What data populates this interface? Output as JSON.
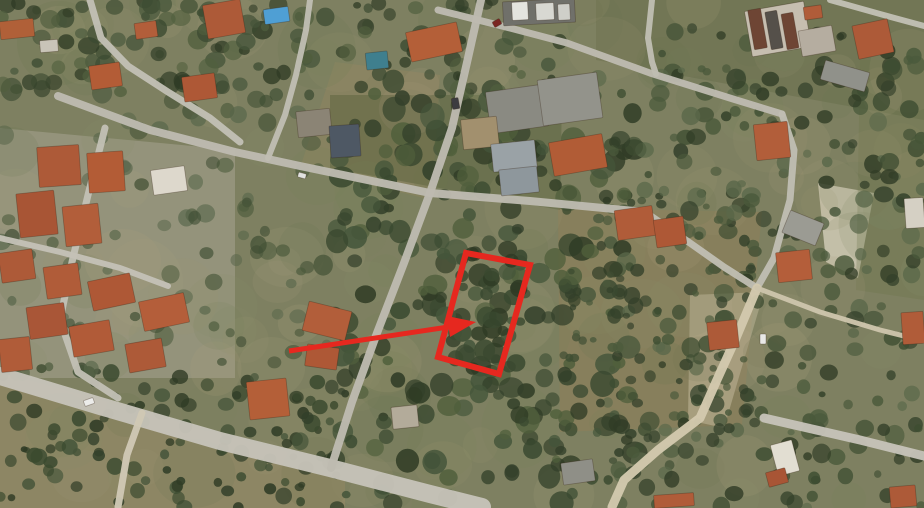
{
  "meta": {
    "description": "Aerial satellite photograph of a residential olive-grove neighbourhood; a red rectangle outlines a tree-covered land parcel and a red arrow points to it from a house to the south-west."
  },
  "scene": {
    "width": 924,
    "height": 508,
    "base_color": "#7e8061",
    "patches": [
      {
        "points": [
          [
            0,
            128
          ],
          [
            235,
            150
          ],
          [
            235,
            378
          ],
          [
            0,
            378
          ]
        ],
        "color": "#b3ae9f",
        "opacity": 0.42
      },
      {
        "points": [
          [
            558,
            208
          ],
          [
            762,
            212
          ],
          [
            742,
            425
          ],
          [
            560,
            432
          ]
        ],
        "color": "#8f7d57",
        "opacity": 0.5
      },
      {
        "points": [
          [
            0,
            372
          ],
          [
            345,
            468
          ],
          [
            345,
            508
          ],
          [
            0,
            508
          ]
        ],
        "color": "#9c8c68",
        "opacity": 0.5
      },
      {
        "points": [
          [
            335,
            62
          ],
          [
            440,
            75
          ],
          [
            432,
            200
          ],
          [
            300,
            168
          ]
        ],
        "color": "#97855f",
        "opacity": 0.4
      },
      {
        "points": [
          [
            818,
            183
          ],
          [
            874,
            193
          ],
          [
            858,
            278
          ],
          [
            826,
            262
          ]
        ],
        "color": "#d9d2bf",
        "opacity": 0.9
      },
      {
        "points": [
          [
            690,
            295
          ],
          [
            764,
            292
          ],
          [
            724,
            428
          ],
          [
            688,
            420
          ]
        ],
        "color": "#cfc5a8",
        "opacity": 0.45
      },
      {
        "points": [
          [
            330,
            95
          ],
          [
            562,
            95
          ],
          [
            560,
            210
          ],
          [
            330,
            168
          ]
        ],
        "color": "#49552f",
        "opacity": 0.35
      },
      {
        "points": [
          [
            596,
            0
          ],
          [
            924,
            0
          ],
          [
            924,
            120
          ],
          [
            596,
            60
          ]
        ],
        "color": "#55603c",
        "opacity": 0.3
      },
      {
        "points": [
          [
            860,
            60
          ],
          [
            924,
            60
          ],
          [
            924,
            300
          ],
          [
            856,
            290
          ]
        ],
        "color": "#6b7448",
        "opacity": 0.3
      }
    ],
    "tree_regions": [
      {
        "seed": 11,
        "x": 0,
        "y": 0,
        "w": 924,
        "h": 508,
        "count": 160,
        "rmin": 16,
        "rmax": 42,
        "opacity": 0.18,
        "palette": [
          "#75805a",
          "#8a8f68",
          "#9c9372",
          "#68744e",
          "#aa9f7d"
        ]
      },
      {
        "seed": 21,
        "x": 330,
        "y": 88,
        "w": 305,
        "h": 420,
        "count": 260,
        "rmin": 4,
        "rmax": 13,
        "opacity": 0.88,
        "palette": [
          "#2f3b25",
          "#3a4930",
          "#44553a",
          "#505f3c",
          "#33402a"
        ]
      },
      {
        "seed": 31,
        "x": 598,
        "y": 28,
        "w": 326,
        "h": 480,
        "count": 300,
        "rmin": 3.5,
        "rmax": 10,
        "opacity": 0.85,
        "palette": [
          "#33402a",
          "#3e4d32",
          "#4a593b",
          "#5a684a",
          "#2f3b25"
        ]
      },
      {
        "seed": 41,
        "x": 0,
        "y": 368,
        "w": 348,
        "h": 140,
        "count": 120,
        "rmin": 3.5,
        "rmax": 8.5,
        "opacity": 0.9,
        "palette": [
          "#33402a",
          "#3b4a2f",
          "#2f3b25",
          "#46553a"
        ]
      },
      {
        "seed": 51,
        "x": 0,
        "y": 0,
        "w": 560,
        "h": 95,
        "count": 140,
        "rmin": 4,
        "rmax": 11,
        "opacity": 0.8,
        "palette": [
          "#3a4930",
          "#46553a",
          "#515f3e",
          "#2f3b25"
        ]
      },
      {
        "seed": 61,
        "x": 0,
        "y": 95,
        "w": 335,
        "h": 285,
        "count": 90,
        "rmin": 4,
        "rmax": 10,
        "opacity": 0.7,
        "palette": [
          "#3e4d32",
          "#4a593b",
          "#57654a"
        ]
      },
      {
        "seed": 71,
        "x": 437,
        "y": 253,
        "w": 92,
        "h": 118,
        "count": 34,
        "rmin": 5,
        "rmax": 11,
        "opacity": 0.9,
        "palette": [
          "#2f3b25",
          "#3a4930",
          "#44553a"
        ]
      },
      {
        "seed": 81,
        "x": 560,
        "y": 200,
        "w": 200,
        "h": 230,
        "count": 70,
        "rmin": 3,
        "rmax": 7,
        "opacity": 0.85,
        "palette": [
          "#3e4d32",
          "#4a593b",
          "#33402a"
        ]
      }
    ],
    "roads": [
      {
        "points": [
          [
            0,
            376
          ],
          [
            100,
            406
          ],
          [
            220,
            441
          ],
          [
            330,
            468
          ],
          [
            430,
            494
          ],
          [
            482,
            507
          ]
        ],
        "width": 18,
        "color": "#c6c3b8"
      },
      {
        "points": [
          [
            142,
            413
          ],
          [
            127,
            455
          ],
          [
            118,
            507
          ]
        ],
        "width": 7,
        "color": "#cfc8b4"
      },
      {
        "points": [
          [
            481,
            0
          ],
          [
            468,
            58
          ],
          [
            452,
            128
          ],
          [
            430,
            193
          ],
          [
            404,
            263
          ],
          [
            377,
            333
          ],
          [
            352,
            402
          ],
          [
            331,
            468
          ]
        ],
        "width": 8,
        "color": "#bdbab0"
      },
      {
        "points": [
          [
            58,
            96
          ],
          [
            150,
            130
          ],
          [
            235,
            152
          ],
          [
            300,
            166
          ],
          [
            430,
            193
          ],
          [
            530,
            201
          ],
          [
            645,
            212
          ]
        ],
        "width": 8,
        "color": "#bdbab0"
      },
      {
        "points": [
          [
            645,
            212
          ],
          [
            690,
            243
          ],
          [
            724,
            267
          ],
          [
            757,
            288
          ]
        ],
        "width": 7,
        "color": "#c0bdb2"
      },
      {
        "points": [
          [
            438,
            10
          ],
          [
            510,
            28
          ],
          [
            567,
            43
          ],
          [
            650,
            73
          ],
          [
            733,
            99
          ],
          [
            782,
            114
          ]
        ],
        "width": 7,
        "color": "#bdbab0"
      },
      {
        "points": [
          [
            782,
            114
          ],
          [
            794,
            150
          ],
          [
            790,
            200
          ],
          [
            774,
            258
          ],
          [
            757,
            288
          ]
        ],
        "width": 7,
        "color": "#c0bdb2"
      },
      {
        "points": [
          [
            757,
            288
          ],
          [
            736,
            338
          ],
          [
            716,
            382
          ],
          [
            700,
            418
          ],
          [
            658,
            450
          ],
          [
            624,
            480
          ],
          [
            612,
            507
          ]
        ],
        "width": 9,
        "color": "#d2c9ae"
      },
      {
        "points": [
          [
            90,
            0
          ],
          [
            101,
            38
          ],
          [
            128,
            66
          ],
          [
            168,
            92
          ],
          [
            210,
            118
          ],
          [
            240,
            142
          ]
        ],
        "width": 7,
        "color": "#c2bfb4"
      },
      {
        "points": [
          [
            105,
            128
          ],
          [
            88,
            195
          ],
          [
            72,
            262
          ],
          [
            60,
            320
          ],
          [
            78,
            372
          ],
          [
            118,
            398
          ]
        ],
        "width": 7,
        "color": "#c2bfb4"
      },
      {
        "points": [
          [
            0,
            238
          ],
          [
            60,
            252
          ],
          [
            120,
            268
          ],
          [
            168,
            286
          ]
        ],
        "width": 6,
        "color": "#c4c1b6"
      },
      {
        "points": [
          [
            652,
            0
          ],
          [
            648,
            38
          ],
          [
            652,
            62
          ],
          [
            656,
            74
          ]
        ],
        "width": 6,
        "color": "#c0bdb2"
      },
      {
        "points": [
          [
            757,
            288
          ],
          [
            820,
            312
          ],
          [
            880,
            330
          ],
          [
            924,
            341
          ]
        ],
        "width": 5,
        "color": "#cdc5ac"
      },
      {
        "points": [
          [
            830,
            0
          ],
          [
            880,
            14
          ],
          [
            924,
            26
          ]
        ],
        "width": 6,
        "color": "#c2bfb4"
      },
      {
        "points": [
          [
            764,
            418
          ],
          [
            860,
            440
          ],
          [
            924,
            456
          ]
        ],
        "width": 9,
        "color": "#c6c3b8"
      },
      {
        "points": [
          [
            268,
            158
          ],
          [
            285,
            115
          ],
          [
            296,
            75
          ],
          [
            306,
            30
          ],
          [
            310,
            0
          ]
        ],
        "width": 6,
        "color": "#c0bdb2"
      }
    ],
    "buildings": [
      [
        38,
        146,
        42,
        40,
        -4,
        "#ad5a38"
      ],
      [
        88,
        152,
        36,
        40,
        -4,
        "#b35c36"
      ],
      [
        18,
        192,
        38,
        44,
        -6,
        "#a85535"
      ],
      [
        64,
        205,
        36,
        40,
        -6,
        "#b25e3a"
      ],
      [
        0,
        251,
        34,
        30,
        -8,
        "#ad5a38"
      ],
      [
        45,
        265,
        35,
        32,
        -8,
        "#b05c39"
      ],
      [
        90,
        277,
        43,
        30,
        -12,
        "#ae5836"
      ],
      [
        141,
        297,
        46,
        30,
        -12,
        "#b45e3a"
      ],
      [
        28,
        305,
        38,
        32,
        -8,
        "#a95637"
      ],
      [
        71,
        323,
        41,
        31,
        -10,
        "#b15b38"
      ],
      [
        127,
        341,
        37,
        29,
        -10,
        "#ad5a38"
      ],
      [
        0,
        338,
        31,
        33,
        -6,
        "#b05c39"
      ],
      [
        152,
        168,
        34,
        25,
        -8,
        "#ddd8cc"
      ],
      [
        0,
        20,
        34,
        18,
        -6,
        "#b06038"
      ],
      [
        135,
        22,
        22,
        16,
        -8,
        "#b25e3a"
      ],
      [
        205,
        2,
        38,
        34,
        -10,
        "#ad5a38"
      ],
      [
        90,
        64,
        31,
        24,
        -8,
        "#b35c36"
      ],
      [
        183,
        75,
        33,
        25,
        -8,
        "#ae5836"
      ],
      [
        40,
        40,
        18,
        12,
        -5,
        "#c9c4b8"
      ],
      [
        264,
        8,
        25,
        15,
        -8,
        "#4f9fd4"
      ],
      [
        408,
        27,
        52,
        30,
        -12,
        "#b45f38"
      ],
      [
        366,
        52,
        22,
        17,
        -6,
        "#3f7f8e"
      ],
      [
        503,
        0,
        72,
        24,
        -3,
        "#70706a"
      ],
      [
        512,
        2,
        16,
        18,
        -3,
        "#e4e4de"
      ],
      [
        536,
        3,
        18,
        17,
        -3,
        "#d8d8d2"
      ],
      [
        558,
        4,
        12,
        16,
        -3,
        "#cfcfc9"
      ],
      [
        488,
        88,
        58,
        42,
        -8,
        "#8a8a82"
      ],
      [
        540,
        76,
        60,
        46,
        -8,
        "#93938b"
      ],
      [
        462,
        118,
        36,
        30,
        -6,
        "#a2906e"
      ],
      [
        492,
        142,
        44,
        28,
        -6,
        "#9aa2a6"
      ],
      [
        500,
        168,
        38,
        26,
        -6,
        "#8e979c"
      ],
      [
        551,
        138,
        54,
        34,
        -10,
        "#b15c36"
      ],
      [
        297,
        110,
        34,
        26,
        -6,
        "#8b8475"
      ],
      [
        330,
        125,
        30,
        32,
        -4,
        "#4e5864"
      ],
      [
        748,
        6,
        60,
        46,
        -10,
        "#c6beb0"
      ],
      [
        751,
        9,
        13,
        40,
        -10,
        "#6e4534"
      ],
      [
        768,
        11,
        12,
        38,
        -10,
        "#55504a"
      ],
      [
        784,
        13,
        12,
        36,
        -10,
        "#6e4534"
      ],
      [
        800,
        28,
        34,
        26,
        -10,
        "#b5ada0"
      ],
      [
        855,
        22,
        36,
        34,
        -12,
        "#ad5a38"
      ],
      [
        804,
        6,
        18,
        13,
        -8,
        "#b05c39"
      ],
      [
        822,
        66,
        46,
        20,
        16,
        "#90918a"
      ],
      [
        755,
        123,
        34,
        36,
        -6,
        "#b25e3a"
      ],
      [
        616,
        208,
        38,
        30,
        -8,
        "#b05c39"
      ],
      [
        655,
        218,
        30,
        28,
        -8,
        "#ae5836"
      ],
      [
        777,
        251,
        34,
        30,
        -6,
        "#b45e3a"
      ],
      [
        708,
        321,
        30,
        28,
        -6,
        "#ad5a38"
      ],
      [
        902,
        312,
        22,
        32,
        -4,
        "#b05c39"
      ],
      [
        785,
        216,
        36,
        24,
        22,
        "#9b9b93"
      ],
      [
        905,
        198,
        19,
        30,
        -4,
        "#d5d0c4"
      ],
      [
        305,
        306,
        44,
        30,
        14,
        "#b25e3a"
      ],
      [
        306,
        346,
        32,
        22,
        8,
        "#ae5836"
      ],
      [
        248,
        380,
        40,
        38,
        -6,
        "#b45f38"
      ],
      [
        562,
        461,
        32,
        22,
        -8,
        "#8f8f87"
      ],
      [
        392,
        406,
        26,
        22,
        -6,
        "#b3ab9a"
      ],
      [
        654,
        494,
        40,
        13,
        -4,
        "#b05c39"
      ],
      [
        774,
        442,
        22,
        32,
        -15,
        "#e2ded2"
      ],
      [
        767,
        470,
        20,
        15,
        -15,
        "#a85535"
      ],
      [
        890,
        486,
        26,
        21,
        -5,
        "#ad5a38"
      ]
    ],
    "vehicles": [
      [
        84,
        399,
        10,
        6,
        -20,
        "#ececea"
      ],
      [
        452,
        98,
        7,
        11,
        -10,
        "#3c3c40"
      ],
      [
        493,
        20,
        8,
        6,
        -30,
        "#7a2622"
      ],
      [
        760,
        334,
        6,
        10,
        0,
        "#e8e8e6"
      ],
      [
        298,
        173,
        8,
        5,
        15,
        "#e2e2e0"
      ]
    ],
    "annotation": {
      "color": "#e6281f",
      "parcel_outline": {
        "points": [
          [
            466,
            253
          ],
          [
            530,
            265
          ],
          [
            499,
            374
          ],
          [
            438,
            357
          ]
        ],
        "stroke_width": 6
      },
      "arrow": {
        "tail": [
          289,
          351
        ],
        "shaft_end": [
          455,
          326
        ],
        "head": [
          [
            476,
            322
          ],
          [
            450,
            337
          ],
          [
            447,
            316
          ]
        ],
        "stroke_width": 5
      }
    }
  }
}
